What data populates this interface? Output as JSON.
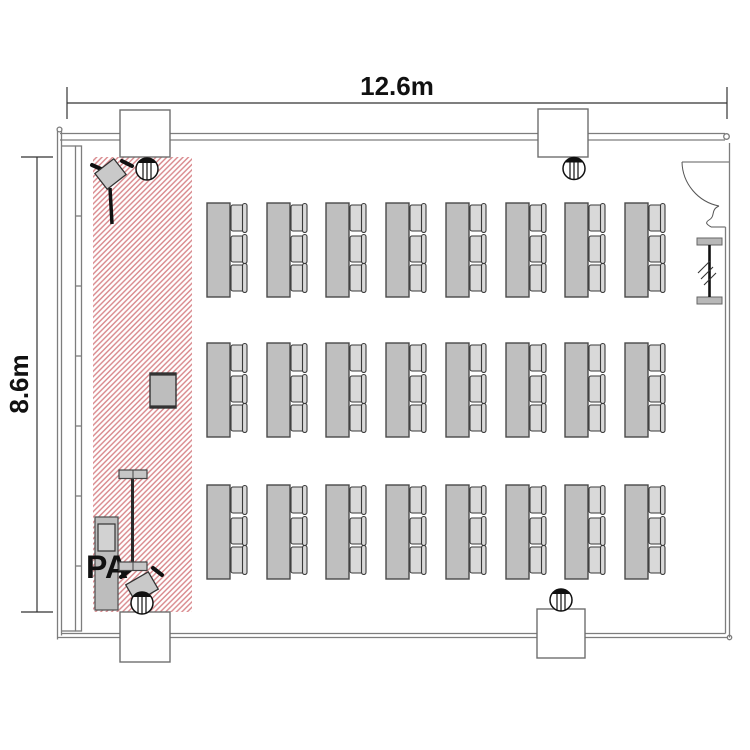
{
  "floor_plan": {
    "width_dimension": "12.6m",
    "height_dimension": "8.6m",
    "pa_label": "PA",
    "colors": {
      "stage_hatch": "#d8878b",
      "furniture_fill": "#bfbfbf",
      "chair_fill": "#d9d9d9",
      "wall_line": "#7d7d7d"
    },
    "furniture": {
      "table_rows": 3,
      "table_columns": 8,
      "chairs_per_table": 3,
      "tables_total": 24,
      "seats_total": 72
    },
    "elements": {
      "stage_area": "stage-hatched-area",
      "door": "entrance-door",
      "columns": 4,
      "ceiling_speakers": 4,
      "stage_speakers": 2,
      "pa_rack": "pa-rack",
      "screen": "screen-stand",
      "lectern": "lectern",
      "partition": "partition-rail"
    }
  }
}
